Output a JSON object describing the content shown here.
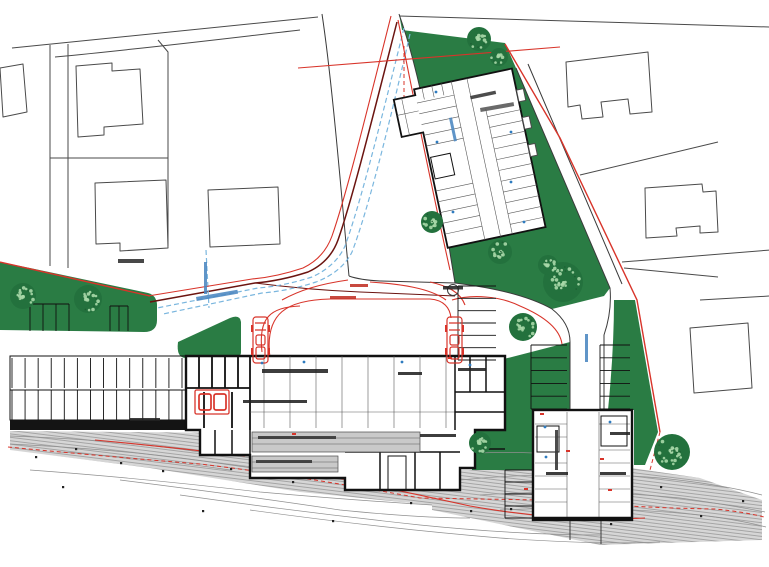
{
  "document": {
    "kind": "architectural-site-plan",
    "note": "scanned site plan; all micro-text labels are below legibility at this resolution"
  },
  "colors": {
    "green": "#2a7c44",
    "green_dark": "#1d5c32",
    "green_light": "#a8d8a8",
    "red": "#d8342a",
    "maroon": "#6b1410",
    "blue": "#7ab6de",
    "blue_text": "#4a86c0",
    "ink": "#3a3a3a",
    "wall": "#111111",
    "parcel": "#4a4a4a",
    "hatch_bg": "#d6d6d6",
    "hatch_line": "#909090"
  },
  "roundabout": {
    "cx": 453,
    "cy": 290,
    "r": 5.5
  },
  "vehicles": [
    {
      "x": 253,
      "y": 317
    },
    {
      "x": 447,
      "y": 317
    }
  ],
  "trees": [
    {
      "cx": 23,
      "cy": 296,
      "r": 13
    },
    {
      "cx": 88,
      "cy": 299,
      "r": 14
    },
    {
      "cx": 479,
      "cy": 39,
      "r": 12
    },
    {
      "cx": 499,
      "cy": 57,
      "r": 9
    },
    {
      "cx": 432,
      "cy": 222,
      "r": 11
    },
    {
      "cx": 500,
      "cy": 252,
      "r": 12
    },
    {
      "cx": 563,
      "cy": 282,
      "r": 20
    },
    {
      "cx": 523,
      "cy": 327,
      "r": 14
    },
    {
      "cx": 548,
      "cy": 265,
      "r": 10
    },
    {
      "cx": 480,
      "cy": 443,
      "r": 11
    },
    {
      "cx": 672,
      "cy": 452,
      "r": 18
    }
  ],
  "stall_groups": [
    {
      "x": 12,
      "y": 358,
      "w": 170,
      "h": 30,
      "n": 13,
      "dir": "v",
      "edges": false
    },
    {
      "x": 12,
      "y": 390,
      "w": 170,
      "h": 30,
      "n": 13,
      "dir": "v",
      "edges": false
    },
    {
      "x": 30,
      "y": 304,
      "w": 39,
      "h": 27,
      "n": 3,
      "dir": "v",
      "edges": true
    },
    {
      "x": 110,
      "y": 306,
      "w": 18,
      "h": 25,
      "n": 2,
      "dir": "v",
      "edges": true
    },
    {
      "x": 458,
      "y": 286,
      "w": 38,
      "h": 74,
      "n": 6,
      "dir": "h",
      "edges": true
    },
    {
      "x": 531,
      "y": 345,
      "w": 36,
      "h": 64,
      "n": 5,
      "dir": "h",
      "edges": true
    },
    {
      "x": 600,
      "y": 345,
      "w": 30,
      "h": 64,
      "n": 5,
      "dir": "h",
      "edges": true
    },
    {
      "x": 505,
      "y": 470,
      "w": 28,
      "h": 48,
      "n": 4,
      "dir": "h",
      "edges": true
    }
  ],
  "micro_labels": [
    {
      "x": 118,
      "y": 259,
      "w": 26,
      "h": 4,
      "c": "#2f2f2f",
      "r": 0
    },
    {
      "x": 480,
      "y": 108,
      "w": 34,
      "h": 4,
      "c": "#555555",
      "r": -10
    },
    {
      "x": 443,
      "y": 286,
      "w": 20,
      "h": 3.5,
      "c": "#222222",
      "r": 0
    },
    {
      "x": 350,
      "y": 284,
      "w": 18,
      "h": 3,
      "c": "#c03024",
      "r": 0
    },
    {
      "x": 330,
      "y": 296,
      "w": 26,
      "h": 3,
      "c": "#c03024",
      "r": 0
    },
    {
      "x": 262,
      "y": 369,
      "w": 66,
      "h": 4,
      "c": "#222222",
      "r": 0
    },
    {
      "x": 243,
      "y": 400,
      "w": 64,
      "h": 3,
      "c": "#222222",
      "r": 0
    },
    {
      "x": 258,
      "y": 436,
      "w": 78,
      "h": 3,
      "c": "#333333",
      "r": 0
    },
    {
      "x": 256,
      "y": 460,
      "w": 56,
      "h": 3,
      "c": "#333333",
      "r": 0
    },
    {
      "x": 398,
      "y": 372,
      "w": 24,
      "h": 3,
      "c": "#222222",
      "r": 0
    },
    {
      "x": 458,
      "y": 368,
      "w": 28,
      "h": 3,
      "c": "#222222",
      "r": 0
    },
    {
      "x": 420,
      "y": 434,
      "w": 36,
      "h": 3,
      "c": "#222222",
      "r": 0
    },
    {
      "x": 546,
      "y": 472,
      "w": 22,
      "h": 3,
      "c": "#222222",
      "r": 0
    },
    {
      "x": 600,
      "y": 472,
      "w": 26,
      "h": 3,
      "c": "#222222",
      "r": 0
    },
    {
      "x": 610,
      "y": 432,
      "w": 20,
      "h": 3,
      "c": "#222222",
      "r": 0
    },
    {
      "x": 130,
      "y": 418,
      "w": 30,
      "h": 3,
      "c": "#222222",
      "r": 0
    },
    {
      "x": 196,
      "y": 297,
      "w": 42,
      "h": 4,
      "c": "#4a86c0",
      "r": -10
    },
    {
      "x": 204,
      "y": 262,
      "w": 3,
      "h": 32,
      "c": "#4a86c0",
      "r": 0
    },
    {
      "x": 585,
      "y": 334,
      "w": 3,
      "h": 28,
      "c": "#4a86c0",
      "r": 0
    },
    {
      "x": 449,
      "y": 118,
      "w": 3,
      "h": 24,
      "c": "#4a86c0",
      "r": -12
    },
    {
      "x": 470,
      "y": 96,
      "w": 26,
      "h": 3.5,
      "c": "#333333",
      "r": -12
    },
    {
      "x": 555,
      "y": 430,
      "w": 3,
      "h": 40,
      "c": "#333333",
      "r": 0
    }
  ],
  "terrain_dots": [
    [
      35,
      456
    ],
    [
      75,
      448
    ],
    [
      120,
      462
    ],
    [
      162,
      470
    ],
    [
      230,
      468
    ],
    [
      292,
      481
    ],
    [
      410,
      502
    ],
    [
      470,
      510
    ],
    [
      610,
      523
    ],
    [
      660,
      486
    ],
    [
      700,
      515
    ],
    [
      742,
      500
    ],
    [
      62,
      486
    ],
    [
      202,
      510
    ],
    [
      332,
      520
    ],
    [
      510,
      508
    ]
  ],
  "blue_dots": [
    [
      436,
      92
    ],
    [
      437,
      142
    ],
    [
      453,
      212
    ],
    [
      511,
      132
    ],
    [
      511,
      182
    ],
    [
      524,
      222
    ],
    [
      545,
      427
    ],
    [
      546,
      457
    ],
    [
      610,
      422
    ],
    [
      262,
      363
    ],
    [
      304,
      362
    ],
    [
      402,
      362
    ],
    [
      470,
      365
    ]
  ],
  "red_marks": [
    [
      540,
      413
    ],
    [
      600,
      458
    ],
    [
      608,
      489
    ],
    [
      566,
      450
    ],
    [
      292,
      433
    ],
    [
      448,
      357
    ],
    [
      524,
      488
    ]
  ]
}
